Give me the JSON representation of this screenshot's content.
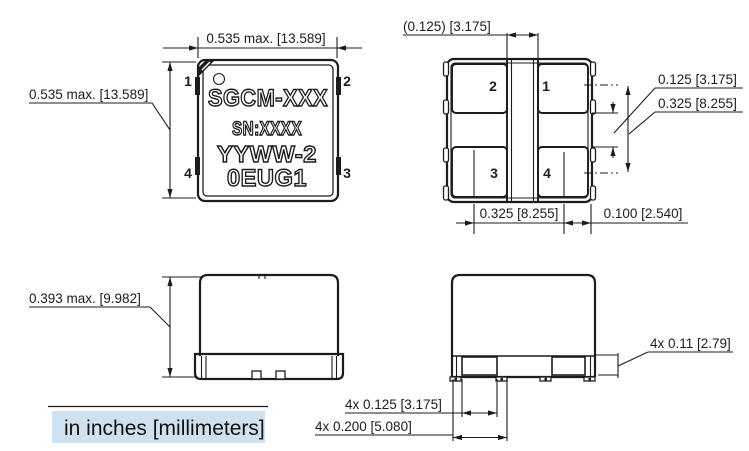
{
  "units_note": "in inches [millimeters]",
  "colors": {
    "ink": "#1c1c1c",
    "note_bg": "#cfe1ef"
  },
  "top_view": {
    "marking": [
      "SGCM-XXX",
      "SN:XXXX",
      "YYWW-2",
      "0EUG1"
    ],
    "pins": {
      "p1": "1",
      "p2": "2",
      "p3": "3",
      "p4": "4"
    },
    "dim_width": "0.535 max. [13.589]",
    "dim_height": "0.535 max. [13.589]"
  },
  "bottom_view": {
    "pads": {
      "p1": "1",
      "p2": "2",
      "p3": "3",
      "p4": "4"
    },
    "dim_center_gap": "(0.125) [3.175]",
    "dim_pad_gap": "0.125 [3.175]",
    "dim_pad_span_v": "0.325 [8.255]",
    "dim_pad_span_h": "0.325 [8.255]",
    "dim_edge": "0.100 [2.540]"
  },
  "side_view": {
    "dim_height": "0.393 max. [9.982]"
  },
  "front_view": {
    "dim_pad_height": "4x 0.11 [2.79]",
    "dim_pad_width": "4x 0.125 [3.175]",
    "dim_pad_pitch": "4x 0.200 [5.080]"
  }
}
